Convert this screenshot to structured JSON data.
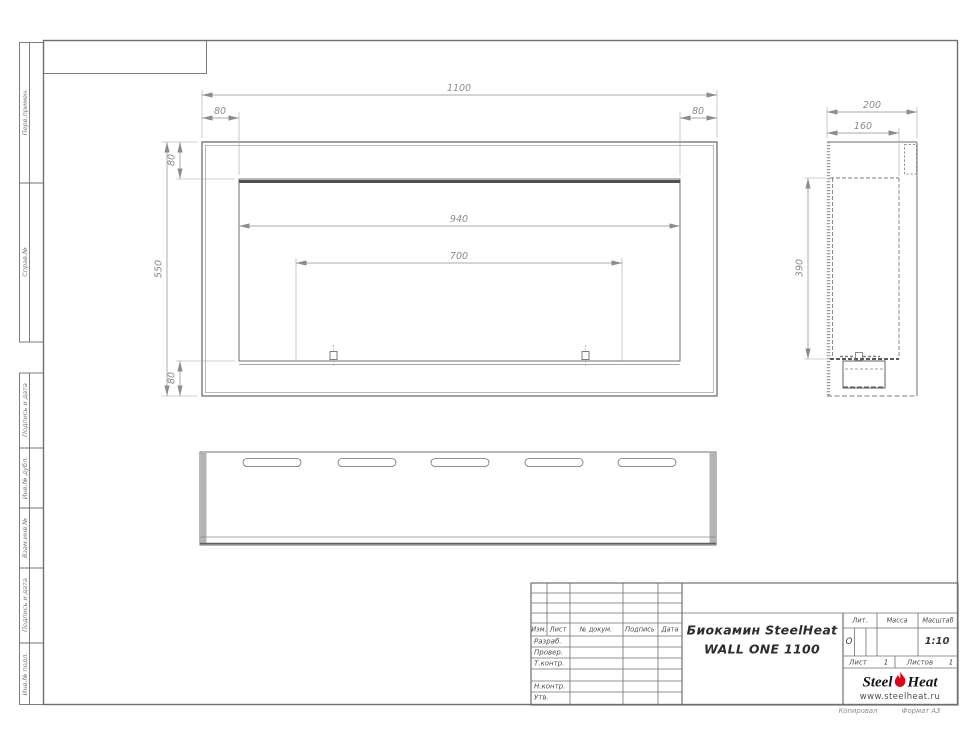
{
  "colors": {
    "line": "#6f6f6f",
    "dim": "#8c8c8c",
    "dark": "#4f4f4f",
    "flame": "#e3001b"
  },
  "left_strip": {
    "labels": [
      "Перв.примен.",
      "Справ.№",
      "Подпись и дата",
      "Инв.№ дубл.",
      "Взам.инв.№",
      "Подпись и дата",
      "Инв.№ подл."
    ]
  },
  "front_view": {
    "dim_total_width": "1100",
    "dim_margin_left": "80",
    "dim_margin_right": "80",
    "dim_total_height": "550",
    "dim_margin_top": "80",
    "dim_margin_bottom": "80",
    "dim_opening_width": "940",
    "dim_burner_width": "700"
  },
  "side_view": {
    "dim_depth": "200",
    "dim_inner_depth": "160",
    "dim_inner_height": "390"
  },
  "bottom_view": {
    "slots": 5
  },
  "title_block": {
    "header_cols": [
      "Изм.",
      "Лист",
      "№ докум.",
      "Подпись",
      "Дата"
    ],
    "rows": [
      "Разраб.",
      "Провер.",
      "Т.контр.",
      "Н.контр.",
      "Утв."
    ],
    "title_line1": "Биокамин SteelHeat",
    "title_line2": "WALL ONE 1100",
    "lit_label": "Лит.",
    "lit_value": "О",
    "mass_label": "Масса",
    "scale_label": "Масштаб",
    "scale_value": "1:10",
    "sheet_label": "Лист",
    "sheet_value": "1",
    "sheets_label": "Листов",
    "sheets_value": "1",
    "logo": {
      "part1": "Steel",
      "part2": "Heat",
      "url": "www.steelheat.ru"
    },
    "footer_left": "Копировал",
    "footer_right": "Формат А3"
  }
}
